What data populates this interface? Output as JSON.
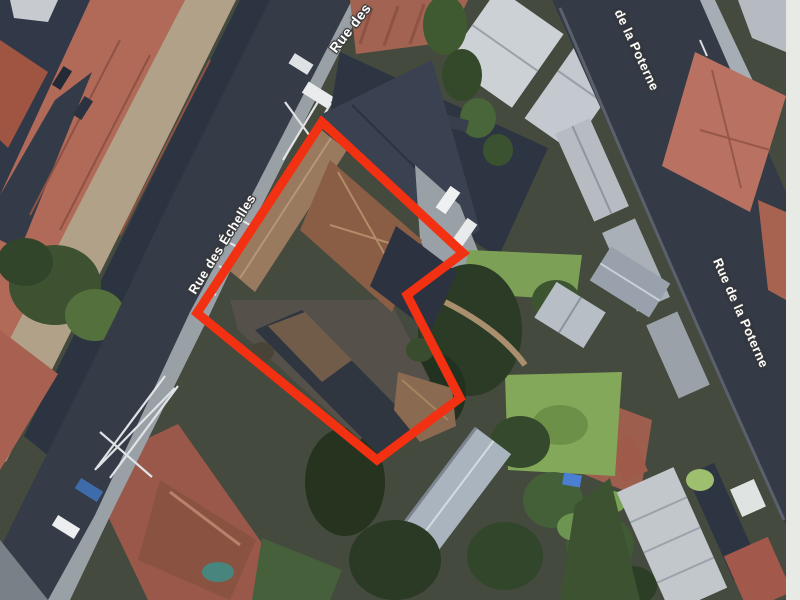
{
  "map": {
    "view_type": "satellite",
    "streets": [
      {
        "name": "Rue des",
        "x": 350,
        "y": 28,
        "rotation": -52
      },
      {
        "name": "Rue des Échelles",
        "x": 222,
        "y": 244,
        "rotation": -58
      },
      {
        "name": "de la Poterne",
        "x": 637,
        "y": 50,
        "rotation": 65
      },
      {
        "name": "Rue de la Poterne",
        "x": 741,
        "y": 313,
        "rotation": 66
      }
    ],
    "highlighted_parcel": {
      "outline_color": "#f23012",
      "stroke_width": 9,
      "points": "322,122 463,253 407,295 460,398 377,460 197,313"
    },
    "label_style": {
      "text_color": "#ffffff",
      "outline_color": "#3c3c3c"
    }
  }
}
